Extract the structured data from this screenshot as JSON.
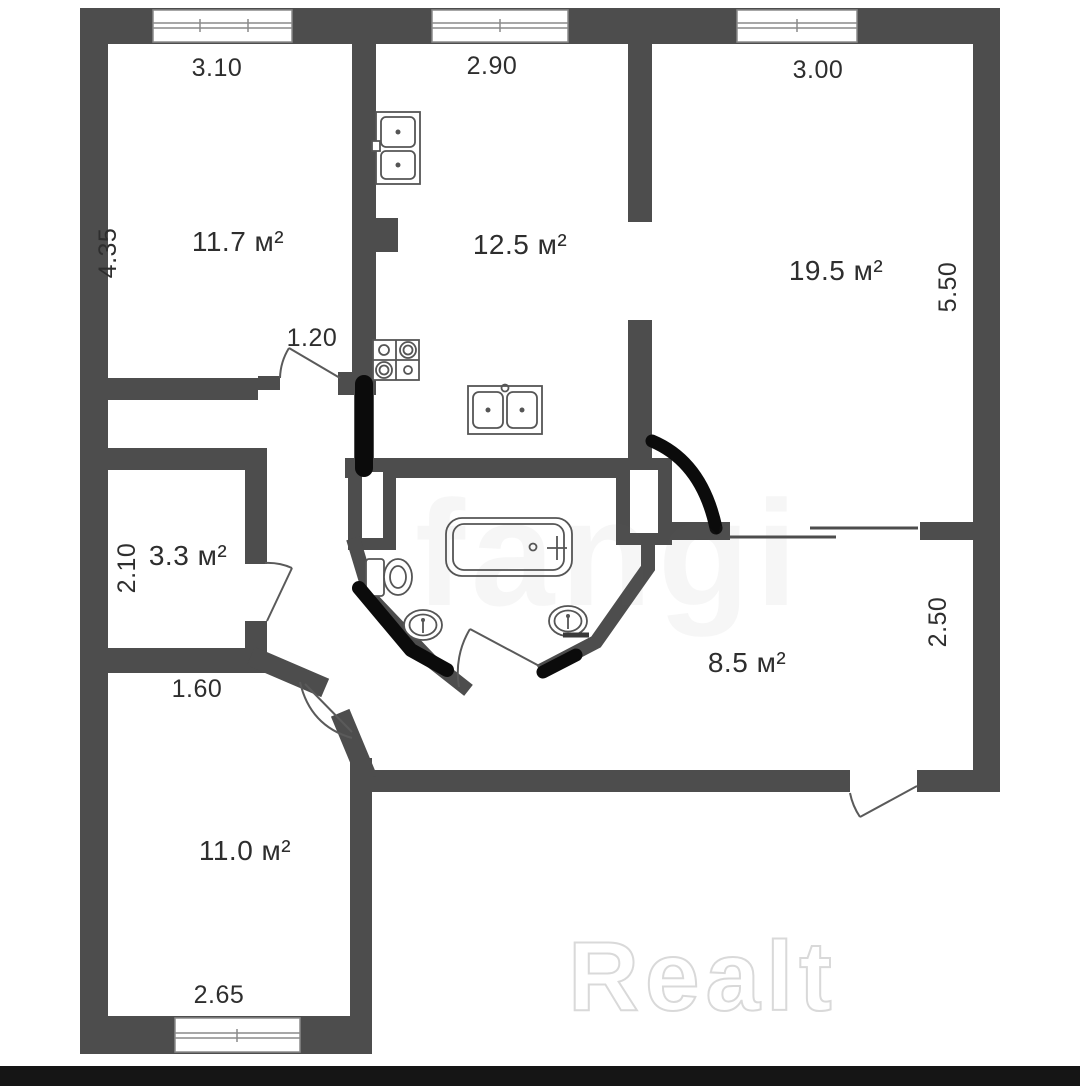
{
  "plan_title": "apartment-floor-plan",
  "areas": {
    "room_tl": "11.7 м²",
    "kitchen": "12.5 м²",
    "room_tr": "19.5 м²",
    "storage": "3.3 м²",
    "hall": "8.5 м²",
    "room_bl": "11.0 м²"
  },
  "dimensions": {
    "room_tl_width": "3.10",
    "room_tl_height": "4.35",
    "kitchen_width": "2.90",
    "room_tr_width": "3.00",
    "room_tr_height": "5.50",
    "door_tl_width": "1.20",
    "storage_height": "2.10",
    "hall_passage_width": "1.60",
    "hall_height": "2.50",
    "room_bl_width": "2.65"
  },
  "fixtures": [
    "kitchen-sink-double-top",
    "stove-four-burner",
    "kitchen-sink-double-bottom",
    "bathtub",
    "toilet",
    "washbasin-left",
    "washbasin-right"
  ],
  "watermark": {
    "brand": "Realt",
    "ghost": "fangi"
  },
  "colors": {
    "wall": "#4d4d4d",
    "marker": "#0b0b0b",
    "line": "#5a5a5a",
    "text": "#2e2e2e",
    "window_frame": "#8a8a8a",
    "fixture": "#555555",
    "bottom_bar": "#151515"
  }
}
